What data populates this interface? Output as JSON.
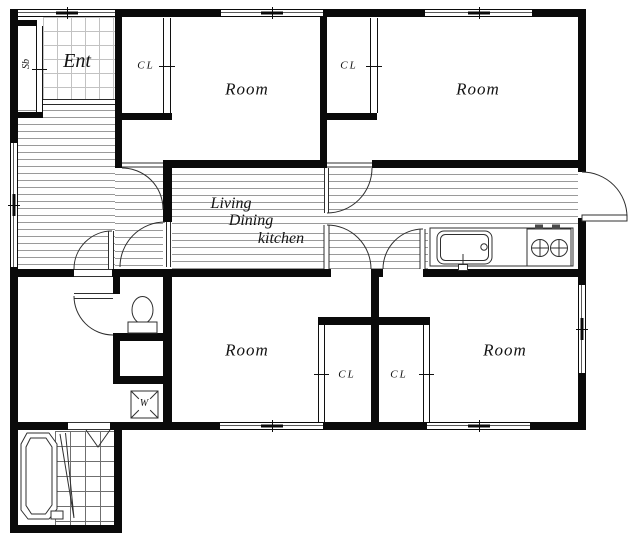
{
  "floor_plan": {
    "background_color": "#ffffff",
    "wall_color": "#0a0a0a",
    "hatch_line_color": "#9a9a9a",
    "labels": {
      "entrance": "Ent",
      "shoe_cabinet": "Sb",
      "closet_top_left": "CL",
      "closet_top_right": "CL",
      "closet_bottom_left": "CL",
      "closet_bottom_right": "CL",
      "room_top_left": "Room",
      "room_top_right": "Room",
      "room_bottom_left": "Room",
      "room_bottom_right": "Room",
      "living": "Living",
      "dining": "Dining",
      "kitchen": "kitchen",
      "washing_machine": "W"
    }
  }
}
